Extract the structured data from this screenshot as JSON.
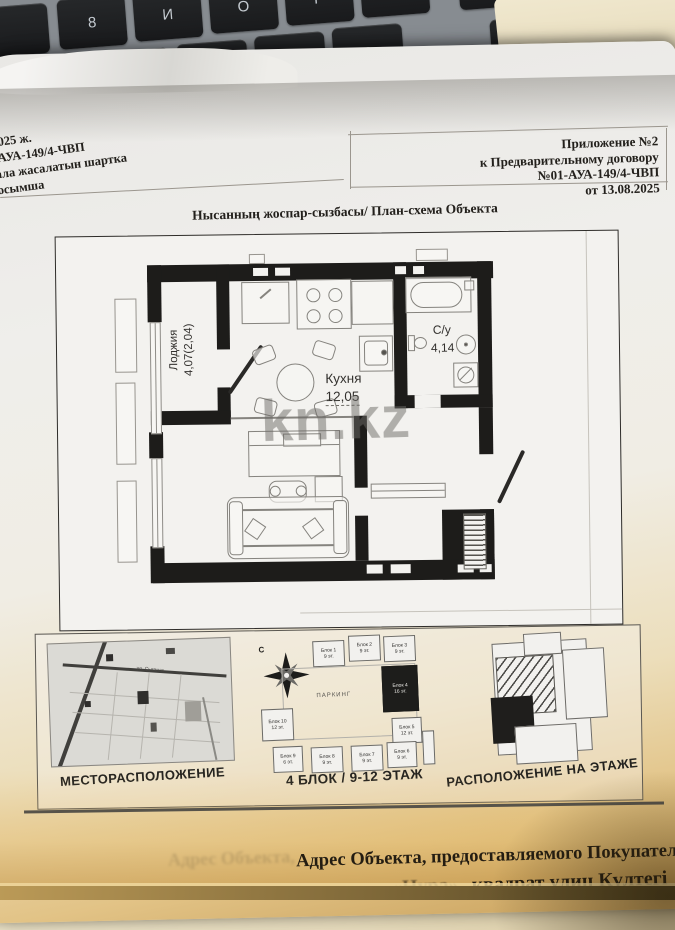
{
  "keyboard": {
    "row1": [
      "8",
      "И",
      "О",
      "Р",
      "Х"
    ],
    "row2": [
      "У",
      "Ш",
      "Ж",
      "Э"
    ],
    "enter": "Enter",
    "shift": "Shift"
  },
  "header": {
    "left_lines": [
      "2025 ж.",
      "-АУА-149/4-ЧВП",
      "ала жасалатын шартка",
      "осымша"
    ],
    "right_lines": [
      "Приложение №2",
      "к Предварительному договору",
      "№01-АУА-149/4-ЧВП",
      "от 13.08.2025"
    ]
  },
  "title": "Нысанның жоспар-сызбасы/ План-схема Объекта",
  "plan": {
    "watermark": "kn.kz",
    "rooms": {
      "loggia_name": "Лоджия",
      "loggia_area": "4,07(2,04)",
      "kitchen_name": "Кухня",
      "kitchen_area": "12,05",
      "bathroom_name": "С/у",
      "bathroom_area": "4,14"
    }
  },
  "panels": {
    "location": {
      "caption": "МЕСТОРАСПОЛОЖЕНИЕ",
      "street_label": "ул. Сыганак"
    },
    "site": {
      "caption": "4 БЛОК / 9-12 ЭТАЖ",
      "compass_label": "С",
      "parking_label": "ПАРКИНГ",
      "blocks": [
        {
          "name": "Блок 1",
          "floors": "9 эт."
        },
        {
          "name": "Блок 2",
          "floors": "9 эт."
        },
        {
          "name": "Блок 3",
          "floors": "9 эт."
        },
        {
          "name": "Блок 4",
          "floors": "16 эт."
        },
        {
          "name": "Блок 5",
          "floors": "12 эт."
        },
        {
          "name": "Блок 6",
          "floors": "9 эт."
        },
        {
          "name": "Блок 7",
          "floors": "9 эт."
        },
        {
          "name": "Блок 8",
          "floors": "9 эт."
        },
        {
          "name": "Блок 9",
          "floors": "6 эт."
        },
        {
          "name": "Блок 10",
          "floors": "12 эт."
        }
      ]
    },
    "floor": {
      "caption": "РАСПОЛОЖЕНИЕ НА ЭТАЖЕ"
    }
  },
  "footer": {
    "ghost_line": "Адрес Объекта,",
    "line1": "Адрес Объекта, предоставляемого Покупател",
    "line2_prefix": "«Нура»,",
    "line2": "квадрат улиц Күлтегі"
  },
  "colors": {
    "paper": "#efeeeb",
    "wall": "#1d1c1a",
    "desk_wood": "#e8dcbc",
    "key": "#222426",
    "watermark_gray": "#6c6a66"
  }
}
